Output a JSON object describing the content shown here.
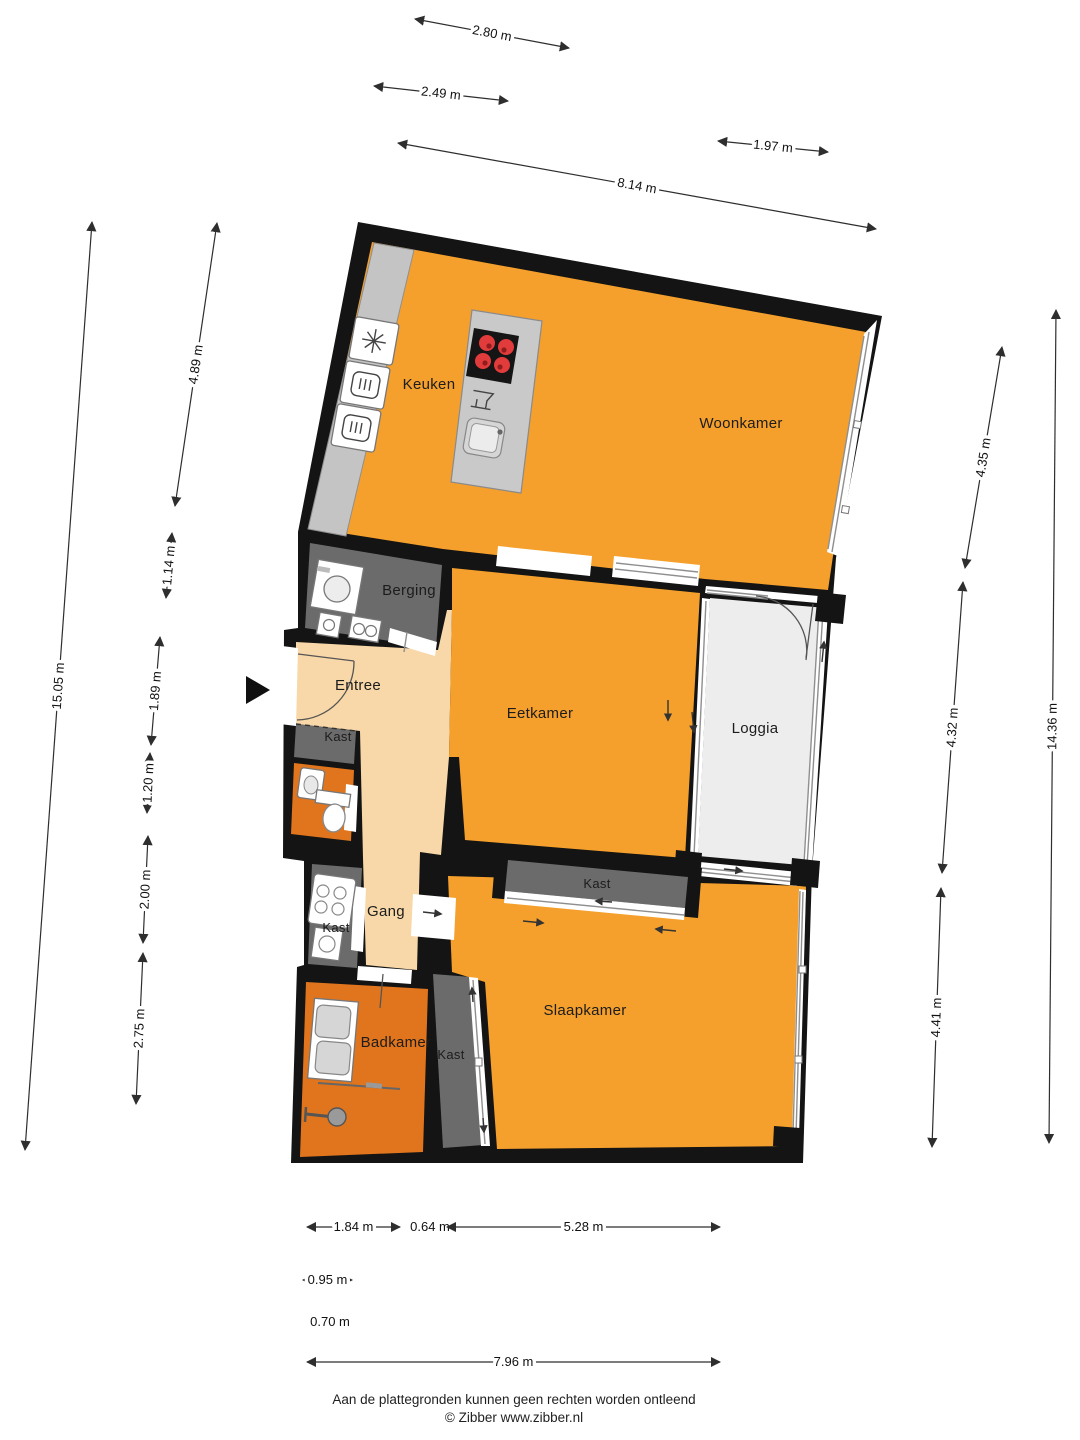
{
  "document": {
    "type": "floor-plan",
    "language": "nl"
  },
  "colors": {
    "wall": "#141414",
    "orange": "#F5A02C",
    "orange_dark": "#E0751D",
    "peach": "#F8D8A8",
    "grayroom": "#6C6B6B",
    "loggia": "#EDEDED",
    "counter": "#C4C4C4",
    "island": "#C9C9C9",
    "burner": "#E23B3B"
  },
  "rooms": [
    {
      "label": "Keuken",
      "x": 429,
      "y": 389
    },
    {
      "label": "Woonkamer",
      "x": 741,
      "y": 428
    },
    {
      "label": "Berging",
      "x": 409,
      "y": 595
    },
    {
      "label": "Entree",
      "x": 358,
      "y": 690
    },
    {
      "label": "Eetkamer",
      "x": 540,
      "y": 718
    },
    {
      "label": "Loggia",
      "x": 755,
      "y": 733
    },
    {
      "label": "Kast",
      "x": 338,
      "y": 741
    },
    {
      "label": "Gang",
      "x": 386,
      "y": 916
    },
    {
      "label": "Kast",
      "x": 336,
      "y": 932
    },
    {
      "label": "Badkamer",
      "x": 396,
      "y": 1047
    },
    {
      "label": "Kast",
      "x": 451,
      "y": 1059
    },
    {
      "label": "Slaapkamer",
      "x": 585,
      "y": 1015
    },
    {
      "label": "Kast",
      "x": 597,
      "y": 888
    }
  ],
  "dimensions": [
    {
      "label": "2.80 m",
      "x1": 415,
      "y1": 19,
      "x2": 569,
      "y2": 48
    },
    {
      "label": "2.49 m",
      "x1": 374,
      "y1": 86,
      "x2": 508,
      "y2": 101
    },
    {
      "label": "1.97 m",
      "x1": 718,
      "y1": 141,
      "x2": 828,
      "y2": 152
    },
    {
      "label": "8.14 m",
      "x1": 398,
      "y1": 143,
      "x2": 876,
      "y2": 229
    },
    {
      "label": "15.05 m",
      "x1": 92,
      "y1": 222,
      "x2": 25,
      "y2": 1150
    },
    {
      "label": "4.89 m",
      "x1": 217,
      "y1": 223,
      "x2": 175,
      "y2": 506
    },
    {
      "label": "1.14 m",
      "x1": 172,
      "y1": 533,
      "x2": 166,
      "y2": 598
    },
    {
      "label": "1.89 m",
      "x1": 160,
      "y1": 637,
      "x2": 151,
      "y2": 745
    },
    {
      "label": "1.20 m",
      "x1": 150,
      "y1": 753,
      "x2": 147,
      "y2": 813
    },
    {
      "label": "2.00 m",
      "x1": 148,
      "y1": 836,
      "x2": 143,
      "y2": 943
    },
    {
      "label": "2.75 m",
      "x1": 143,
      "y1": 953,
      "x2": 136,
      "y2": 1104
    },
    {
      "label": "4.35 m",
      "x1": 1002,
      "y1": 347,
      "x2": 965,
      "y2": 568
    },
    {
      "label": "4.32 m",
      "x1": 963,
      "y1": 582,
      "x2": 942,
      "y2": 873
    },
    {
      "label": "4.41 m",
      "x1": 941,
      "y1": 888,
      "x2": 932,
      "y2": 1147
    },
    {
      "label": "14.36 m",
      "x1": 1056,
      "y1": 310,
      "x2": 1049,
      "y2": 1143
    },
    {
      "label": "1.84 m",
      "x1": 307,
      "y1": 1227,
      "x2": 400,
      "y2": 1227
    },
    {
      "label": "0.64 m",
      "text_only": true,
      "x": 430,
      "y": 1227
    },
    {
      "label": "5.28 m",
      "x1": 447,
      "y1": 1227,
      "x2": 720,
      "y2": 1227
    },
    {
      "label": "0.95 m",
      "x1": 303,
      "y1": 1280,
      "x2": 352,
      "y2": 1280
    },
    {
      "label": "0.70 m",
      "text_only": true,
      "x": 330,
      "y": 1322
    },
    {
      "label": "7.96 m",
      "x1": 307,
      "y1": 1362,
      "x2": 720,
      "y2": 1362
    }
  ],
  "footer": {
    "disclaimer": "Aan de plattegronden kunnen geen rechten worden ontleend",
    "credit": "© Zibber www.zibber.nl"
  },
  "icons": {
    "washing_machine": "square-with-drum-circle",
    "extractor_hood": "asterisk-fan",
    "oven": "rounded-square-heat-waves",
    "cooktop": "black-square-four-red-burners",
    "dishwasher": "glass-symbol",
    "sink": "rounded-square-basin",
    "toilet": "bowl-with-cistern",
    "washbasin": "small-basin",
    "heater": "box-four-circles",
    "boiler": "box-circle",
    "shower": "head-with-arm",
    "entrance_marker": "solid-right-triangle",
    "sliding_door": "white-rail-strip-arrows"
  }
}
